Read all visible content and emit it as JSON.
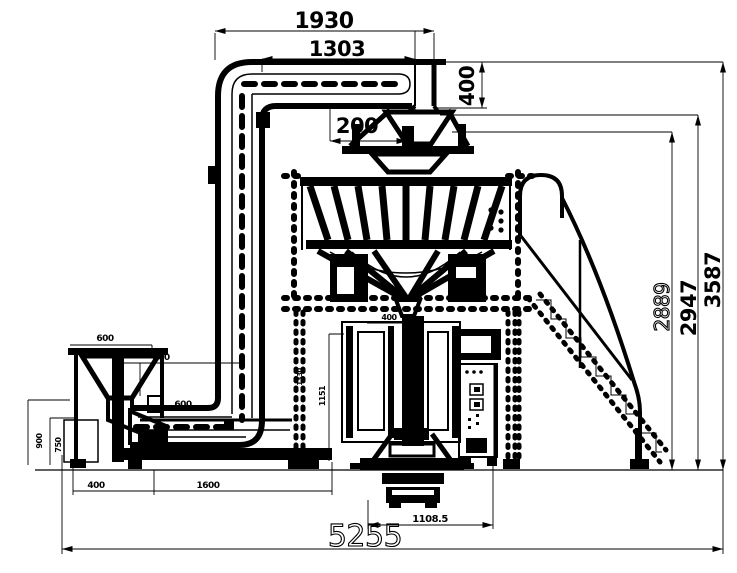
{
  "meta": {
    "drawing_type": "packaging machine side elevation",
    "background": "#ffffff",
    "line_color": "#000000"
  },
  "dims": {
    "top_width": "1930",
    "top_inner_width": "1303",
    "elevator_head_height": "400",
    "hopper_offset": "200",
    "weigher_top_height": "2889",
    "frame_top_height": "2947",
    "overall_height": "3587",
    "outfeed_width": "1108.5",
    "overall_width": "5255",
    "former_width": "400",
    "bagger_height": "1151",
    "support_height": "1330",
    "feeder_hopper_width": "600",
    "feeder_offset": "800",
    "feeder_height_outer": "900",
    "feeder_height_inner": "750",
    "feeder_base_a": "400",
    "feeder_base_b": "1600",
    "elevator_base_width": "600"
  }
}
